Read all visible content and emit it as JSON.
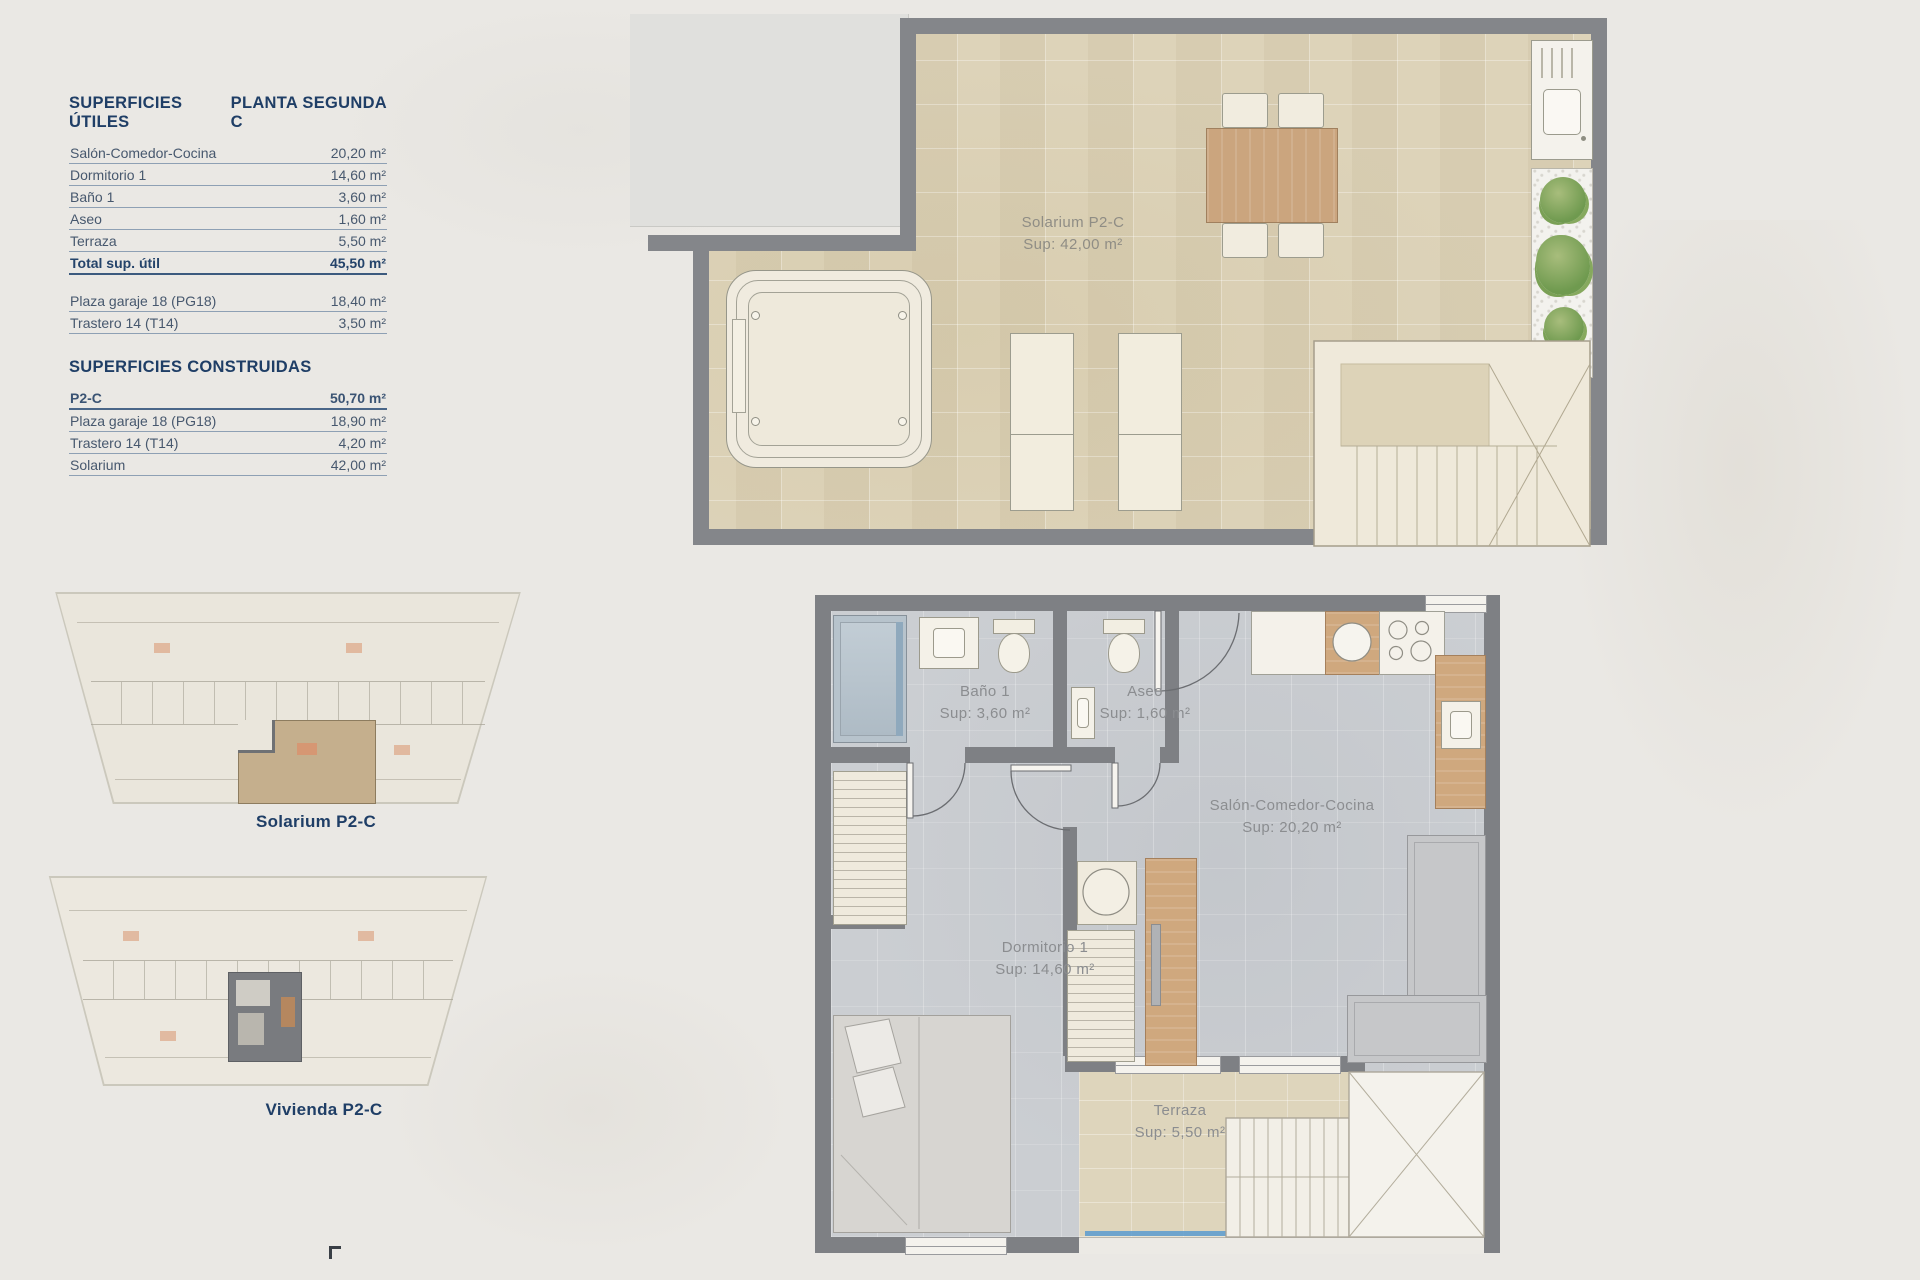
{
  "palette": {
    "accent_navy": "#1f3e66",
    "wall_gray": "#7e8084",
    "tile_beige": "#ddd3b9",
    "floor_gray": "#cbced2",
    "wood": "#cfa87e",
    "plant_green": "#6f9a4f",
    "glass_blue": "#5b9bd0",
    "paper": "#eae8e4"
  },
  "tables": {
    "utiles": {
      "title_left": "SUPERFICIES ÚTILES",
      "title_right": "PLANTA SEGUNDA C",
      "rows": [
        {
          "label": "Salón-Comedor-Cocina",
          "value": "20,20 m²"
        },
        {
          "label": "Dormitorio 1",
          "value": "14,60 m²"
        },
        {
          "label": "Baño 1",
          "value": "3,60 m²"
        },
        {
          "label": "Aseo",
          "value": "1,60 m²"
        },
        {
          "label": "Terraza",
          "value": "5,50 m²"
        }
      ],
      "total": {
        "label": "Total sup. útil",
        "value": "45,50 m²"
      },
      "extra_rows": [
        {
          "label": "Plaza garaje 18 (PG18)",
          "value": "18,40 m²"
        },
        {
          "label": "Trastero 14 (T14)",
          "value": "3,50 m²"
        }
      ]
    },
    "construidas": {
      "title": "SUPERFICIES CONSTRUIDAS",
      "rows": [
        {
          "label": "P2-C",
          "value": "50,70 m²"
        },
        {
          "label": "Plaza garaje 18 (PG18)",
          "value": "18,90 m²"
        },
        {
          "label": "Trastero 14 (T14)",
          "value": "4,20 m²"
        },
        {
          "label": "Solarium",
          "value": "42,00 m²"
        }
      ]
    }
  },
  "mini_plans": [
    {
      "label": "Solarium P2-C"
    },
    {
      "label": "Vivienda P2-C"
    }
  ],
  "solarium_plan": {
    "room_label": "Solarium P2-C",
    "room_area": "Sup: 42,00 m²"
  },
  "vivienda_plan": {
    "rooms": [
      {
        "name": "Baño 1",
        "area": "Sup: 3,60 m²"
      },
      {
        "name": "Aseo",
        "area": "Sup: 1,60 m²"
      },
      {
        "name": "Salón-Comedor-Cocina",
        "area": "Sup: 20,20 m²"
      },
      {
        "name": "Dormitorio 1",
        "area": "Sup: 14,60 m²"
      },
      {
        "name": "Terraza",
        "area": "Sup: 5,50 m²"
      }
    ]
  }
}
